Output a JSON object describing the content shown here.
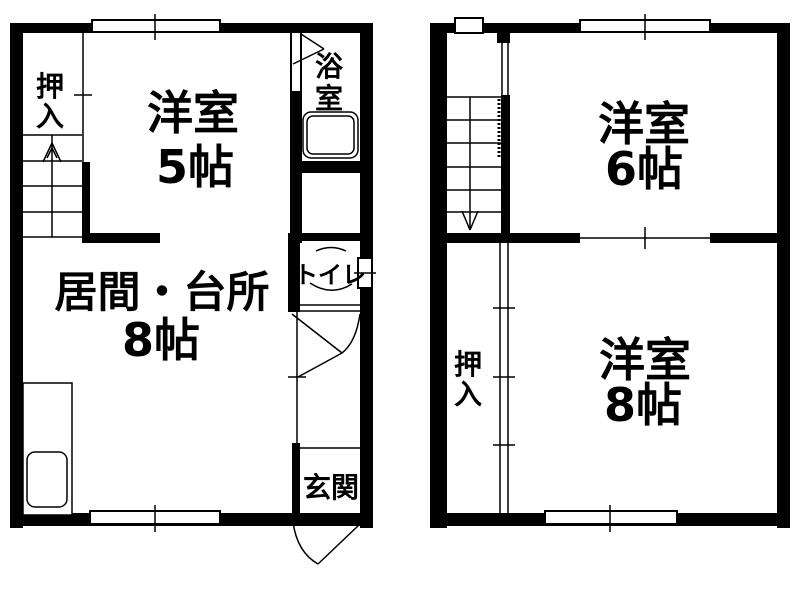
{
  "colors": {
    "line": "#000000",
    "background": "#ffffff"
  },
  "floor1": {
    "closet": {
      "label": "押入"
    },
    "western_room": {
      "name": "洋室",
      "size": "5帖"
    },
    "bathroom": {
      "label": "浴室"
    },
    "living_kitchen": {
      "name": "居間・台所",
      "size": "8帖"
    },
    "toilet": {
      "label": "トイレ"
    },
    "entrance": {
      "label": "玄関"
    }
  },
  "floor2": {
    "western_room_small": {
      "name": "洋室",
      "size": "6帖"
    },
    "western_room_large": {
      "name": "洋室",
      "size": "8帖"
    },
    "closet": {
      "label": "押入"
    }
  }
}
